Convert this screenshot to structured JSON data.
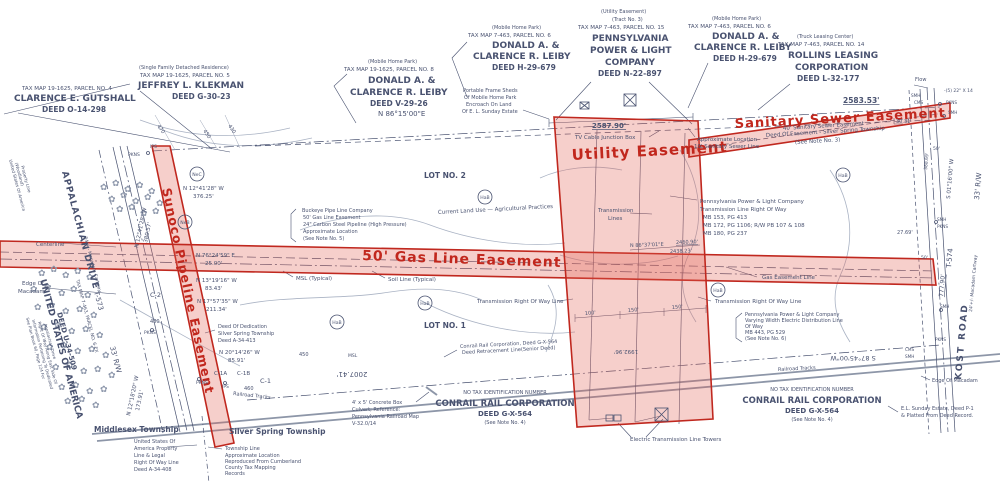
{
  "colors": {
    "ink": "#49527000",
    "ink_": "#495270",
    "red": "#c1271d",
    "red_fill": "rgba(224,96,84,0.30)",
    "contour": "#9aa3b6",
    "rail": "#8d96a8"
  },
  "symbols": {
    "flower": "✿",
    "tower": "tower-box-x",
    "manhole": "circle"
  },
  "easements": {
    "sunoco": "Sunoco Pipeline Easement",
    "gas": "50' Gas Line Easement",
    "utility": "Utility Easement",
    "sewer": "Sanitary Sewer Easement"
  },
  "soil_circles": [
    {
      "t": "NeC",
      "x": 197,
      "y": 174
    },
    {
      "t": "NeB",
      "x": 185,
      "y": 222
    },
    {
      "t": "HaB",
      "x": 485,
      "y": 197
    },
    {
      "t": "HaB",
      "x": 425,
      "y": 303
    },
    {
      "t": "HaB",
      "x": 337,
      "y": 322
    },
    {
      "t": "HaB",
      "x": 718,
      "y": 290
    },
    {
      "t": "HaB",
      "x": 843,
      "y": 175
    }
  ],
  "labels": [
    {
      "t": "TAX MAP 19-1625, PARCEL NO. 4",
      "x": 22,
      "y": 90,
      "s": 5.5
    },
    {
      "t": "CLARENCE E. GUTSHALL",
      "x": 14,
      "y": 101,
      "s": 9,
      "w": 1
    },
    {
      "t": "DEED O-14-298",
      "x": 42,
      "y": 112,
      "s": 7.5,
      "w": 1
    },
    {
      "t": "(Single Family Detached Residence)",
      "x": 139,
      "y": 69,
      "s": 5
    },
    {
      "t": "TAX MAP 19-1625, PARCEL NO. 5",
      "x": 140,
      "y": 77,
      "s": 5.5
    },
    {
      "t": "JEFFREY L. KLEKMAN",
      "x": 138,
      "y": 88,
      "s": 9,
      "w": 1
    },
    {
      "t": "DEED G-30-23",
      "x": 172,
      "y": 99,
      "s": 7.5,
      "w": 1
    },
    {
      "t": "(Mobile Home Park)",
      "x": 368,
      "y": 63,
      "s": 5
    },
    {
      "t": "TAX MAP 19-1625, PARCEL NO. 8",
      "x": 344,
      "y": 71,
      "s": 5.5
    },
    {
      "t": "DONALD A. &",
      "x": 368,
      "y": 83,
      "s": 9,
      "w": 1
    },
    {
      "t": "CLARENCE R. LEIBY",
      "x": 350,
      "y": 95,
      "s": 9,
      "w": 1
    },
    {
      "t": "DEED V-29-26",
      "x": 370,
      "y": 106,
      "s": 7.5,
      "w": 1
    },
    {
      "t": "(Mobile Home Park)",
      "x": 492,
      "y": 29,
      "s": 5
    },
    {
      "t": "TAX MAP 7-463, PARCEL NO. 6",
      "x": 468,
      "y": 37,
      "s": 5.5
    },
    {
      "t": "DONALD A. &",
      "x": 492,
      "y": 48,
      "s": 9,
      "w": 1
    },
    {
      "t": "CLARENCE R. LEIBY",
      "x": 473,
      "y": 59,
      "s": 9,
      "w": 1
    },
    {
      "t": "DEED H-29-679",
      "x": 492,
      "y": 70,
      "s": 7.5,
      "w": 1
    },
    {
      "t": "(Utility Easement)",
      "x": 601,
      "y": 13,
      "s": 5
    },
    {
      "t": "(Tract No. 3)",
      "x": 612,
      "y": 21,
      "s": 5
    },
    {
      "t": "TAX MAP 7-463, PARCEL NO. 15",
      "x": 578,
      "y": 29,
      "s": 5.5
    },
    {
      "t": "PENNSYLVANIA",
      "x": 592,
      "y": 41,
      "s": 9,
      "w": 1
    },
    {
      "t": "POWER & LIGHT",
      "x": 590,
      "y": 53,
      "s": 9,
      "w": 1
    },
    {
      "t": "COMPANY",
      "x": 605,
      "y": 65,
      "s": 9,
      "w": 1
    },
    {
      "t": "DEED N-22-897",
      "x": 598,
      "y": 76,
      "s": 7.5,
      "w": 1
    },
    {
      "t": "(Mobile Home Park)",
      "x": 712,
      "y": 20,
      "s": 5
    },
    {
      "t": "TAX MAP 7-463, PARCEL NO. 6",
      "x": 688,
      "y": 28,
      "s": 5.5
    },
    {
      "t": "DONALD A. &",
      "x": 712,
      "y": 39,
      "s": 9,
      "w": 1
    },
    {
      "t": "CLARENCE R. LEIBY",
      "x": 694,
      "y": 50,
      "s": 9,
      "w": 1
    },
    {
      "t": "DEED H-29-679",
      "x": 713,
      "y": 61,
      "s": 7.5,
      "w": 1
    },
    {
      "t": "(Truck Leasing Center)",
      "x": 797,
      "y": 38,
      "s": 5
    },
    {
      "t": "TAX MAP 7-463, PARCEL NO. 14",
      "x": 778,
      "y": 46,
      "s": 5.5
    },
    {
      "t": "ROLLINS LEASING",
      "x": 788,
      "y": 58,
      "s": 9,
      "w": 1
    },
    {
      "t": "CORPORATION",
      "x": 795,
      "y": 70,
      "s": 9,
      "w": 1
    },
    {
      "t": "DEED L-32-177",
      "x": 797,
      "y": 81,
      "s": 7.5,
      "w": 1
    },
    {
      "t": "Portable Frame Sheds",
      "x": 463,
      "y": 92,
      "s": 5
    },
    {
      "t": "Of Mobile Home Park",
      "x": 464,
      "y": 99,
      "s": 5
    },
    {
      "t": "Encroach On Land",
      "x": 466,
      "y": 106,
      "s": 5
    },
    {
      "t": "Of E. L. Sunday Estate",
      "x": 462,
      "y": 113,
      "s": 5
    },
    {
      "t": "N 86°15'00\"E",
      "x": 378,
      "y": 116,
      "s": 7
    },
    {
      "t": "2587.90'",
      "x": 592,
      "y": 128,
      "s": 7,
      "w": 1,
      "u": 1
    },
    {
      "t": "TV Cable Junction Box",
      "x": 575,
      "y": 139,
      "s": 5.5
    },
    {
      "t": "Utility Easement",
      "x": 572,
      "y": 160,
      "s": 15,
      "c": "red",
      "rot": -3,
      "ls": 1,
      "w": 1,
      "n": "easement-title-utility"
    },
    {
      "t": "Sanitary Sewer Easement",
      "x": 735,
      "y": 128,
      "s": 13,
      "c": "red",
      "rot": -3,
      "ls": 1,
      "w": 1,
      "n": "easement-title-sewer"
    },
    {
      "t": "40' Sanitary Sewer Easement",
      "x": 783,
      "y": 130,
      "s": 5.5,
      "rot": -3.5
    },
    {
      "t": "Deed Of Easement - Silver Spring Township",
      "x": 766,
      "y": 137,
      "s": 5.5,
      "rot": -3.5
    },
    {
      "t": "(See Note No. 3)",
      "x": 795,
      "y": 144,
      "s": 5.5,
      "rot": -3.5
    },
    {
      "t": "Approximate Location",
      "x": 697,
      "y": 141,
      "s": 5.5
    },
    {
      "t": "10' Sanitary Sewer Line",
      "x": 694,
      "y": 148,
      "s": 5.5
    },
    {
      "t": "2583.53'",
      "x": 843,
      "y": 103,
      "s": 7.5,
      "w": 1,
      "u": 1
    },
    {
      "t": "Flow",
      "x": 915,
      "y": 81,
      "s": 5
    },
    {
      "t": "-(5) 22\" X 14",
      "x": 944,
      "y": 92,
      "s": 4.5
    },
    {
      "t": "SMH",
      "x": 911,
      "y": 97,
      "s": 4.2
    },
    {
      "t": "CMS",
      "x": 914,
      "y": 104,
      "s": 4.2
    },
    {
      "t": "PKNS",
      "x": 946,
      "y": 104,
      "s": 4.2
    },
    {
      "t": "SMH",
      "x": 948,
      "y": 114,
      "s": 4.2
    },
    {
      "t": "30.31",
      "x": 896,
      "y": 123,
      "s": 5
    },
    {
      "t": "Pennsylvania Power & Light Company",
      "x": 700,
      "y": 203,
      "s": 5.5
    },
    {
      "t": "Transmission Line Right Of Way",
      "x": 700,
      "y": 211,
      "s": 5.5
    },
    {
      "t": "MB 153, PG 413",
      "x": 703,
      "y": 219,
      "s": 5.5
    },
    {
      "t": "MB 172, PG 1106; R/W PB 107 & 108",
      "x": 703,
      "y": 227,
      "s": 5.5
    },
    {
      "t": "MB 180, PG 237",
      "x": 703,
      "y": 235,
      "s": 5.5
    },
    {
      "t": "Transmission",
      "x": 598,
      "y": 212,
      "s": 5.5
    },
    {
      "t": "Lines",
      "x": 608,
      "y": 220,
      "s": 5.5
    },
    {
      "t": "Current Land Use — Agricultural Practices",
      "x": 438,
      "y": 214,
      "s": 5.5,
      "rot": -3
    },
    {
      "t": "Buckeye Pipe Line Company",
      "x": 302,
      "y": 212,
      "s": 5
    },
    {
      "t": "50' Gas Line Easement",
      "x": 303,
      "y": 219,
      "s": 5
    },
    {
      "t": "24\" Carbon Steel Pipeline (High Pressure)",
      "x": 303,
      "y": 226,
      "s": 5
    },
    {
      "t": "Approximate Location",
      "x": 303,
      "y": 233,
      "s": 5
    },
    {
      "t": "(See Note No. 5)",
      "x": 303,
      "y": 240,
      "s": 5
    },
    {
      "t": "50' Gas Line Easement",
      "x": 362,
      "y": 260,
      "s": 14,
      "c": "red",
      "rot": 2,
      "ls": 1,
      "w": 1,
      "n": "easement-title-gas"
    },
    {
      "t": "Sunoco Pipeline Easement",
      "x": 162,
      "y": 189,
      "s": 12.5,
      "c": "red",
      "rot": 78,
      "ls": 1,
      "w": 1,
      "n": "easement-title-sunoco"
    },
    {
      "t": "MSL (Typical)",
      "x": 296,
      "y": 280,
      "s": 5.5
    },
    {
      "t": "Soil Line (Typical)",
      "x": 388,
      "y": 281,
      "s": 5.5
    },
    {
      "t": "LOT NO. 2",
      "x": 424,
      "y": 178,
      "s": 7.5,
      "w": 1
    },
    {
      "t": "LOT NO. 1",
      "x": 424,
      "y": 328,
      "s": 7.5,
      "w": 1
    },
    {
      "t": "N 86°37'01\"E",
      "x": 630,
      "y": 247,
      "s": 5,
      "rot": -2
    },
    {
      "t": "2460.90'",
      "x": 676,
      "y": 244,
      "s": 5,
      "rot": -2,
      "u": 1
    },
    {
      "t": "2438.23'",
      "x": 670,
      "y": 253,
      "s": 5,
      "rot": -2
    },
    {
      "t": "N 12°41'28\" W",
      "x": 183,
      "y": 190,
      "s": 5.5
    },
    {
      "t": "376.25'",
      "x": 193,
      "y": 198,
      "s": 5.5
    },
    {
      "t": "N 76°24'59\" E",
      "x": 196,
      "y": 257,
      "s": 5.5
    },
    {
      "t": "25.00'",
      "x": 205,
      "y": 265,
      "s": 5.5
    },
    {
      "t": "N 13°19'16\" W",
      "x": 196,
      "y": 282,
      "s": 5.5
    },
    {
      "t": "83.43'",
      "x": 205,
      "y": 290,
      "s": 5.5
    },
    {
      "t": "N 17°57'35\" W",
      "x": 197,
      "y": 303,
      "s": 5.5
    },
    {
      "t": "211.34'",
      "x": 206,
      "y": 311,
      "s": 5.5
    },
    {
      "t": "Deed Of Dedication",
      "x": 218,
      "y": 328,
      "s": 5
    },
    {
      "t": "Silver Spring Township",
      "x": 218,
      "y": 335,
      "s": 5
    },
    {
      "t": "Deed A-34-413",
      "x": 218,
      "y": 342,
      "s": 5
    },
    {
      "t": "N 20°14'26\" W",
      "x": 219,
      "y": 354,
      "s": 5.5
    },
    {
      "t": "85.91'",
      "x": 228,
      "y": 362,
      "s": 5.5
    },
    {
      "t": "C-1A",
      "x": 214,
      "y": 375,
      "s": 5.5
    },
    {
      "t": "C-1B",
      "x": 237,
      "y": 375,
      "s": 5.5
    },
    {
      "t": "C-1",
      "x": 260,
      "y": 383,
      "s": 6.5
    },
    {
      "t": "C-2",
      "x": 150,
      "y": 297,
      "s": 6.5
    },
    {
      "t": "PKNS",
      "x": 196,
      "y": 384,
      "s": 4.5
    },
    {
      "t": "IPS",
      "x": 222,
      "y": 388,
      "s": 4.5
    },
    {
      "t": "PKNS",
      "x": 144,
      "y": 334,
      "s": 4.5
    },
    {
      "t": "480",
      "x": 150,
      "y": 323,
      "s": 5
    },
    {
      "t": "460",
      "x": 244,
      "y": 390,
      "s": 5
    },
    {
      "t": "450",
      "x": 299,
      "y": 356,
      "s": 5
    },
    {
      "t": "MSL",
      "x": 348,
      "y": 357,
      "s": 4.5
    },
    {
      "t": "2007.41'",
      "x": 352,
      "y": 372,
      "s": 7,
      "rot": 180,
      "a": "middle"
    },
    {
      "t": "Railroad Tracks",
      "x": 233,
      "y": 395,
      "s": 5,
      "rot": 6
    },
    {
      "t": "Railroad Tracks",
      "x": 778,
      "y": 371,
      "s": 5,
      "rot": -3
    },
    {
      "t": "4' x 5' Concrete Box",
      "x": 352,
      "y": 404,
      "s": 5
    },
    {
      "t": "Culvert; Reference:",
      "x": 352,
      "y": 411,
      "s": 5
    },
    {
      "t": "Pennsylvania Railroad Map",
      "x": 352,
      "y": 418,
      "s": 5
    },
    {
      "t": "V-32.0/14",
      "x": 352,
      "y": 425,
      "s": 5
    },
    {
      "t": "NO TAX IDENTIFICATION NUMBER",
      "x": 505,
      "y": 394,
      "s": 5,
      "a": "middle"
    },
    {
      "t": "CONRAIL RAIL CORPORATION",
      "x": 505,
      "y": 406,
      "s": 8.5,
      "a": "middle",
      "w": 1
    },
    {
      "t": "DEED G-X-564",
      "x": 505,
      "y": 416,
      "s": 7,
      "a": "middle",
      "w": 1
    },
    {
      "t": "(See Note No. 4)",
      "x": 505,
      "y": 424,
      "s": 5,
      "a": "middle"
    },
    {
      "t": "NO TAX IDENTIFICATION NUMBER",
      "x": 812,
      "y": 391,
      "s": 5,
      "a": "middle"
    },
    {
      "t": "CONRAIL RAIL CORPORATION",
      "x": 812,
      "y": 403,
      "s": 8.5,
      "a": "middle",
      "w": 1
    },
    {
      "t": "DEED G-X-564",
      "x": 812,
      "y": 413,
      "s": 7,
      "a": "middle",
      "w": 1
    },
    {
      "t": "(See Note No. 4)",
      "x": 812,
      "y": 421,
      "s": 5,
      "a": "middle"
    },
    {
      "t": "E.L. Sunday Estate, Deed P-1",
      "x": 901,
      "y": 410,
      "s": 5
    },
    {
      "t": "& Platted From Deed Record.",
      "x": 901,
      "y": 417,
      "s": 5
    },
    {
      "t": "Electric Transmission Line Towers",
      "x": 630,
      "y": 441,
      "s": 5.5
    },
    {
      "t": "Middlesex Township",
      "x": 94,
      "y": 432,
      "s": 7.5,
      "w": 1
    },
    {
      "t": "Silver Spring Township",
      "x": 229,
      "y": 434,
      "s": 7.5,
      "w": 1
    },
    {
      "t": "United States Of",
      "x": 134,
      "y": 443,
      "s": 5
    },
    {
      "t": "America Property",
      "x": 134,
      "y": 450,
      "s": 5
    },
    {
      "t": "Line & Legal",
      "x": 134,
      "y": 457,
      "s": 5
    },
    {
      "t": "Right Of Way Line",
      "x": 134,
      "y": 464,
      "s": 5
    },
    {
      "t": "Deed A-34-408",
      "x": 134,
      "y": 471,
      "s": 5
    },
    {
      "t": "Township Line",
      "x": 225,
      "y": 450,
      "s": 5
    },
    {
      "t": "Approximate Location",
      "x": 225,
      "y": 457,
      "s": 5
    },
    {
      "t": "Reproduced From Cumberland",
      "x": 225,
      "y": 463,
      "s": 5
    },
    {
      "t": "County Tax Mapping",
      "x": 225,
      "y": 469,
      "s": 5
    },
    {
      "t": "Records",
      "x": 225,
      "y": 475,
      "s": 5
    },
    {
      "t": "Conrail Rail Corporation, Deed G-X-564",
      "x": 460,
      "y": 348,
      "s": 5,
      "rot": -3
    },
    {
      "t": "Deed Retracement Line(Senior Deed)",
      "x": 462,
      "y": 354,
      "s": 5,
      "rot": -3
    },
    {
      "t": "Transmission Right Of Way Line",
      "x": 477,
      "y": 303,
      "s": 5.5
    },
    {
      "t": "Transmission Right Of Way Line",
      "x": 715,
      "y": 303,
      "s": 5.5
    },
    {
      "t": "100'",
      "x": 585,
      "y": 315,
      "s": 5,
      "rot": -5
    },
    {
      "t": "150'",
      "x": 628,
      "y": 312,
      "s": 5,
      "rot": -5
    },
    {
      "t": "150'",
      "x": 672,
      "y": 309,
      "s": 5,
      "rot": -5
    },
    {
      "t": "1992.96'",
      "x": 626,
      "y": 350,
      "s": 5.5,
      "rot": 180,
      "a": "middle"
    },
    {
      "t": "Gas Easement Line",
      "x": 762,
      "y": 279,
      "s": 5.5
    },
    {
      "t": "Pennsylvania Power & Light Company",
      "x": 745,
      "y": 316,
      "s": 5
    },
    {
      "t": "Varying Width Electric Distribution Line",
      "x": 745,
      "y": 322,
      "s": 5
    },
    {
      "t": "Of Way",
      "x": 745,
      "y": 328,
      "s": 5
    },
    {
      "t": "MB 443, PG 529",
      "x": 745,
      "y": 334,
      "s": 5
    },
    {
      "t": "(See Note No. 6)",
      "x": 745,
      "y": 340,
      "s": 5
    },
    {
      "t": "S 87°45'00\"W",
      "x": 853,
      "y": 356,
      "s": 6.5,
      "rot": 180,
      "a": "middle"
    },
    {
      "t": "KOST   ROAD",
      "x": 961,
      "y": 380,
      "s": 9,
      "rot": -85,
      "ls": 2,
      "w": 1
    },
    {
      "t": "T-574",
      "x": 951,
      "y": 268,
      "s": 7,
      "rot": -85
    },
    {
      "t": "24'+/- Macadam Cartway",
      "x": 972,
      "y": 312,
      "s": 4.5,
      "rot": -85
    },
    {
      "t": "33' R/W",
      "x": 979,
      "y": 200,
      "s": 7,
      "rot": -85
    },
    {
      "t": "S 01°16'00\" W",
      "x": 950,
      "y": 199,
      "s": 5.5,
      "rot": -85
    },
    {
      "t": "777.90'",
      "x": 943,
      "y": 297,
      "s": 6,
      "rot": -85,
      "u": 1
    },
    {
      "t": "388.69'",
      "x": 927,
      "y": 170,
      "s": 4.5,
      "rot": -85
    },
    {
      "t": "50'",
      "x": 933,
      "y": 150,
      "s": 4.5
    },
    {
      "t": "50'",
      "x": 921,
      "y": 259,
      "s": 4.5
    },
    {
      "t": "27.69'",
      "x": 897,
      "y": 234,
      "s": 5
    },
    {
      "t": "SMH",
      "x": 937,
      "y": 221,
      "s": 4.2
    },
    {
      "t": "PKNS",
      "x": 937,
      "y": 228,
      "s": 4.2
    },
    {
      "t": "SMH",
      "x": 940,
      "y": 308,
      "s": 4.2
    },
    {
      "t": "PKNS",
      "x": 935,
      "y": 341,
      "s": 4.2
    },
    {
      "t": "CMS",
      "x": 905,
      "y": 351,
      "s": 4.2
    },
    {
      "t": "SMH",
      "x": 905,
      "y": 358,
      "s": 4.2
    },
    {
      "t": "Edge Of Macadam",
      "x": 932,
      "y": 382,
      "s": 5
    },
    {
      "t": "APPALACHIAN   DRIVE",
      "x": 62,
      "y": 172,
      "s": 9,
      "rot": 75,
      "ls": 1,
      "w": 1
    },
    {
      "t": "24'+/- Macadam Cartway",
      "x": 84,
      "y": 237,
      "s": 4.5,
      "rot": 75
    },
    {
      "t": "T-573",
      "x": 94,
      "y": 292,
      "s": 7,
      "rot": 75
    },
    {
      "t": "33' R/W",
      "x": 110,
      "y": 347,
      "s": 7,
      "rot": 75
    },
    {
      "t": "UNITED STATES OF AMERICA",
      "x": 40,
      "y": 280,
      "s": 9,
      "rot": 75,
      "w": 1
    },
    {
      "t": "DEED U-34-509",
      "x": 57,
      "y": 313,
      "s": 7,
      "rot": 75,
      "w": 1
    },
    {
      "t": "TAX MAP 7-463, PARCEL NO. 6-EX",
      "x": 76,
      "y": 280,
      "s": 4.5,
      "rot": 75
    },
    {
      "t": "See Plan Book 60, Page 124 For",
      "x": 26,
      "y": 318,
      "s": 4,
      "rot": 75
    },
    {
      "t": "Information Pertaining To Dedicated",
      "x": 32,
      "y": 320,
      "s": 4,
      "rot": 75
    },
    {
      "t": "Right Of Way Along East Side Of",
      "x": 38,
      "y": 322,
      "s": 4,
      "rot": 75
    },
    {
      "t": "Appalachian Drive",
      "x": 44,
      "y": 324,
      "s": 4,
      "rot": 75
    },
    {
      "t": "United States Of America",
      "x": 9,
      "y": 160,
      "s": 4.2,
      "rot": 75
    },
    {
      "t": "(Woodland)",
      "x": 15,
      "y": 163,
      "s": 4.2,
      "rot": 75
    },
    {
      "t": "Property Line",
      "x": 21,
      "y": 166,
      "s": 4.2,
      "rot": 75
    },
    {
      "t": "N 12°41'28\" W",
      "x": 138,
      "y": 248,
      "s": 5.5,
      "rot": -78
    },
    {
      "t": "380.57'",
      "x": 147,
      "y": 243,
      "s": 5.5,
      "rot": -78
    },
    {
      "t": "N 12°18'20\" W",
      "x": 130,
      "y": 416,
      "s": 5.5,
      "rot": -78
    },
    {
      "t": "173.91'",
      "x": 139,
      "y": 411,
      "s": 5.5,
      "rot": -78
    },
    {
      "t": "Centerline",
      "x": 36,
      "y": 246,
      "s": 5.5
    },
    {
      "t": "Edge Of",
      "x": 22,
      "y": 285,
      "s": 5.5
    },
    {
      "t": "Macadam",
      "x": 18,
      "y": 293,
      "s": 5.5
    },
    {
      "t": "PKNS",
      "x": 128,
      "y": 156,
      "s": 4.5
    },
    {
      "t": "IPS",
      "x": 150,
      "y": 148,
      "s": 4.5
    },
    {
      "t": "470",
      "x": 157,
      "y": 126,
      "s": 5,
      "rot": 55
    },
    {
      "t": "450",
      "x": 203,
      "y": 131,
      "s": 5,
      "rot": 55
    },
    {
      "t": "430",
      "x": 228,
      "y": 126,
      "s": 5,
      "rot": 55
    }
  ]
}
